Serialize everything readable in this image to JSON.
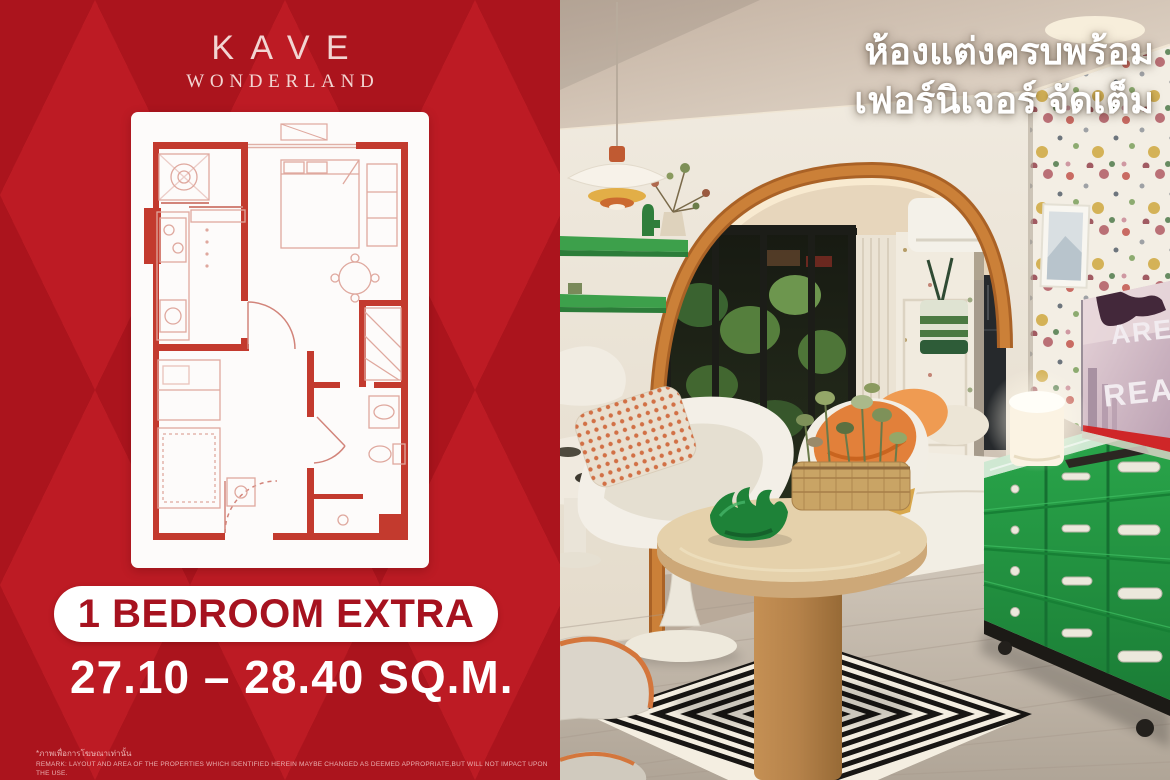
{
  "brand": {
    "name": "KAVE",
    "wordmark_sub": "WONDERLAND"
  },
  "left_panel": {
    "unit_type": "1 BEDROOM EXTRA",
    "unit_area": "27.10 – 28.40 SQ.M.",
    "disclaimer_thai": "*ภาพเพื่อการโฆษณาเท่านั้น",
    "disclaimer_english": "REMARK: LAYOUT AND AREA OF THE PROPERTIES WHICH IDENTIFIED HEREIN MAYBE CHANGED AS DEEMED APPROPRIATE,BUT WILL NOT IMPACT UPON THE USE."
  },
  "photo_overlay": {
    "line1": "ห้องแต่งครบพร้อม",
    "line2": "เฟอร์นิเจอร์ จัดเต็ม"
  },
  "tv_screen": {
    "line1": "ARE",
    "line2": "REA"
  },
  "colors": {
    "panel_red": "#bd1b24",
    "panel_red_dark": "#ab141d",
    "badge_text_red": "#a6121f",
    "floor_plan_red": "#c33a2e",
    "arch_terracotta": "#c27a36",
    "shelf_green": "#3da04b",
    "dresser_green": "#27a047",
    "accent_orange": "#e2803a",
    "tv_strip_red": "#cf2628",
    "text_white": "#ffffff"
  }
}
